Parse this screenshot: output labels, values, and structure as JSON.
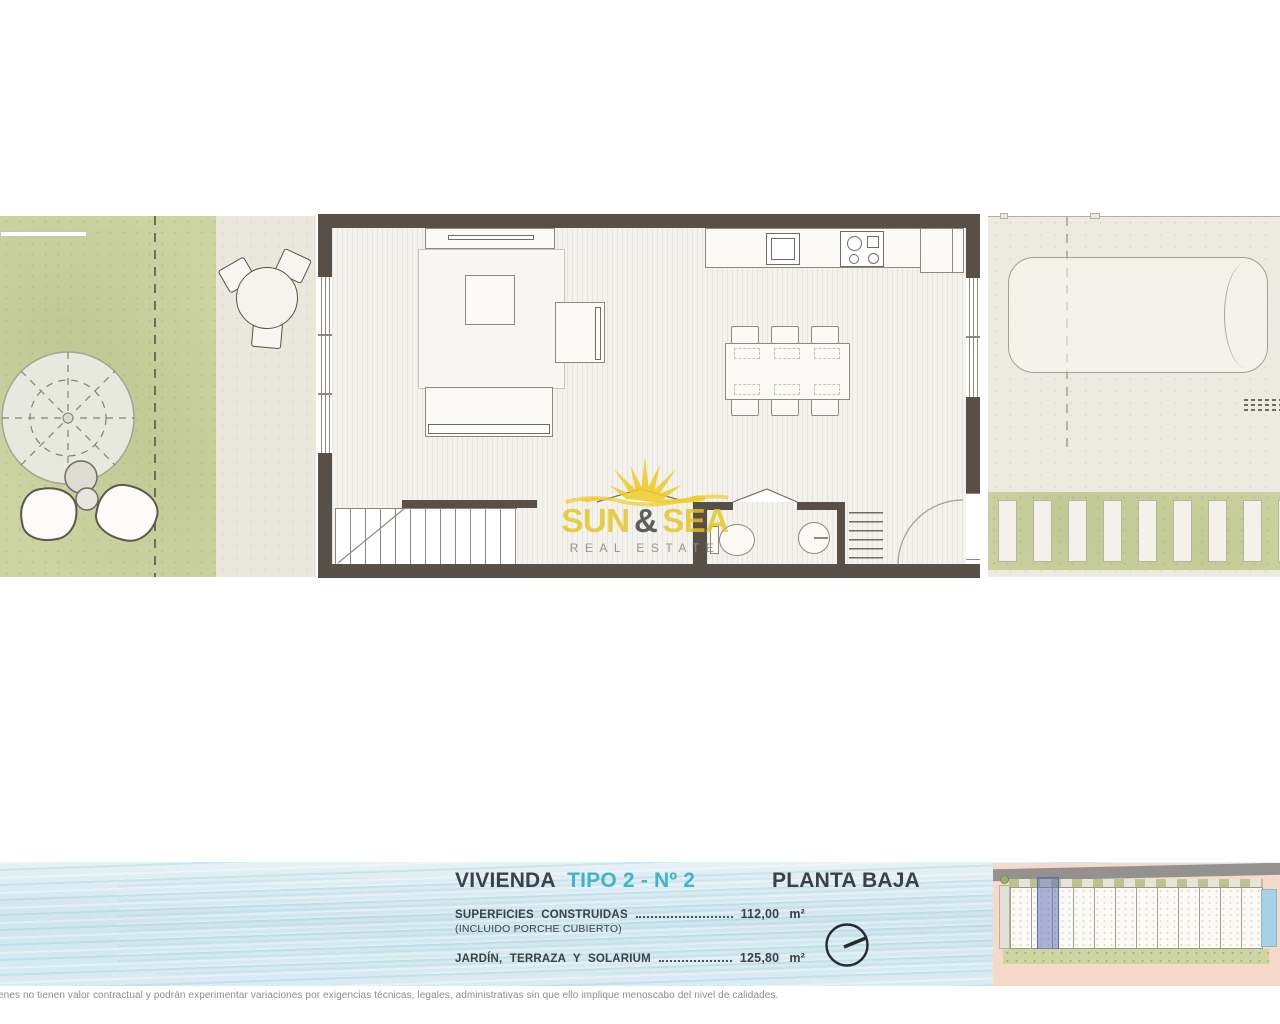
{
  "header": {
    "title": "VIVIENDA",
    "title_accent": "TIPO 2 - Nº 2",
    "floor": "PLANTA BAJA"
  },
  "surfaces": {
    "rows": [
      {
        "label": "SUPERFICIES CONSTRUIDAS",
        "note": "(INCLUIDO PORCHE CUBIERTO)",
        "value": "112,00",
        "unit": "m²"
      },
      {
        "label": "JARDÍN, TERRAZA Y SOLARIUM",
        "note": "",
        "value": "125,80",
        "unit": "m²"
      }
    ]
  },
  "brand": {
    "word1": "SUN",
    "amp": "&",
    "word2": "SEA",
    "tagline": "REAL ESTATE"
  },
  "disclaimer": "enes no tienen valor contractual y podrán experimentar variaciones por exigencias técnicas, legales, administrativas sin que ello implique menoscabo del nivel de calidades.",
  "icons": {
    "compass": "compass-north-icon",
    "sun_logo": "sunburst-icon"
  },
  "colors": {
    "accent": "#41b4c9",
    "wall": "#585047",
    "lawn": "#ccd4a2",
    "terrace": "#eae7dc",
    "paving": "#edebe0",
    "water": "#d4e8f0",
    "brand_yellow": "#e9c724",
    "site_highlight": "#5a6cb0",
    "site_background": "#f7d9ca"
  }
}
